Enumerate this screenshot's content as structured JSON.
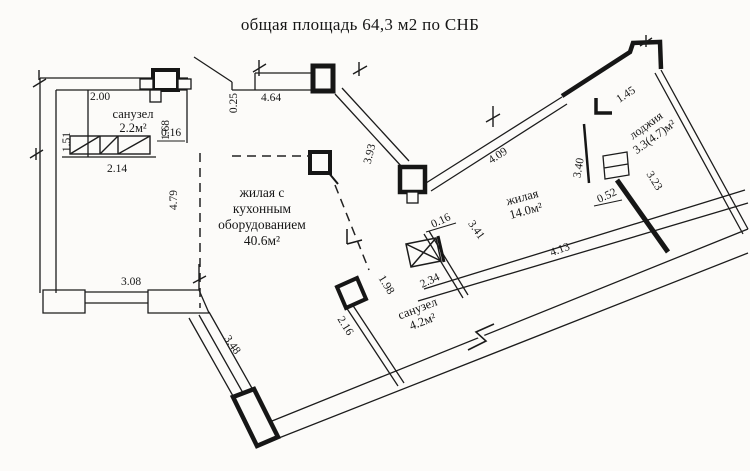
{
  "title": "общая площадь 64,3 м2 по СНБ",
  "rooms": {
    "bathroom_top": {
      "name": "санузел",
      "area": "2.2м²"
    },
    "living_kitchen": {
      "line1": "жилая с",
      "line2": "кухонным",
      "line3": "оборудованием",
      "area": "40.6м²"
    },
    "living": {
      "name": "жилая",
      "area": "14.0м²"
    },
    "loggia": {
      "name": "лоджия",
      "area": "3.3(4.7)м²"
    },
    "bathroom_main": {
      "name": "санузел",
      "area": "4.2м²"
    }
  },
  "dimensions": {
    "top_left_width": "2.00",
    "left_upper": "1.51",
    "bathroom_top_right": "1.68",
    "bathroom_top_wall": "0.16",
    "bathroom_top_bottom": "2.14",
    "entry_wall_thickness": "0.25",
    "top_wall": "4.64",
    "diag_top": "3.93",
    "diag_upper_right": "4.09",
    "loggia_left": "3.40",
    "loggia_top": "1.45",
    "loggia_side": "3.23",
    "loggia_pier": "0.52",
    "living_door": "0.16",
    "living_left": "3.41",
    "living_bottom": "4.13",
    "bath_right": "2.34",
    "bath_top": "1.98",
    "bath_left": "2.16",
    "bottom_left_wall": "3.08",
    "bottom_diag_wall": "3.48",
    "left_room_height": "4.79"
  }
}
